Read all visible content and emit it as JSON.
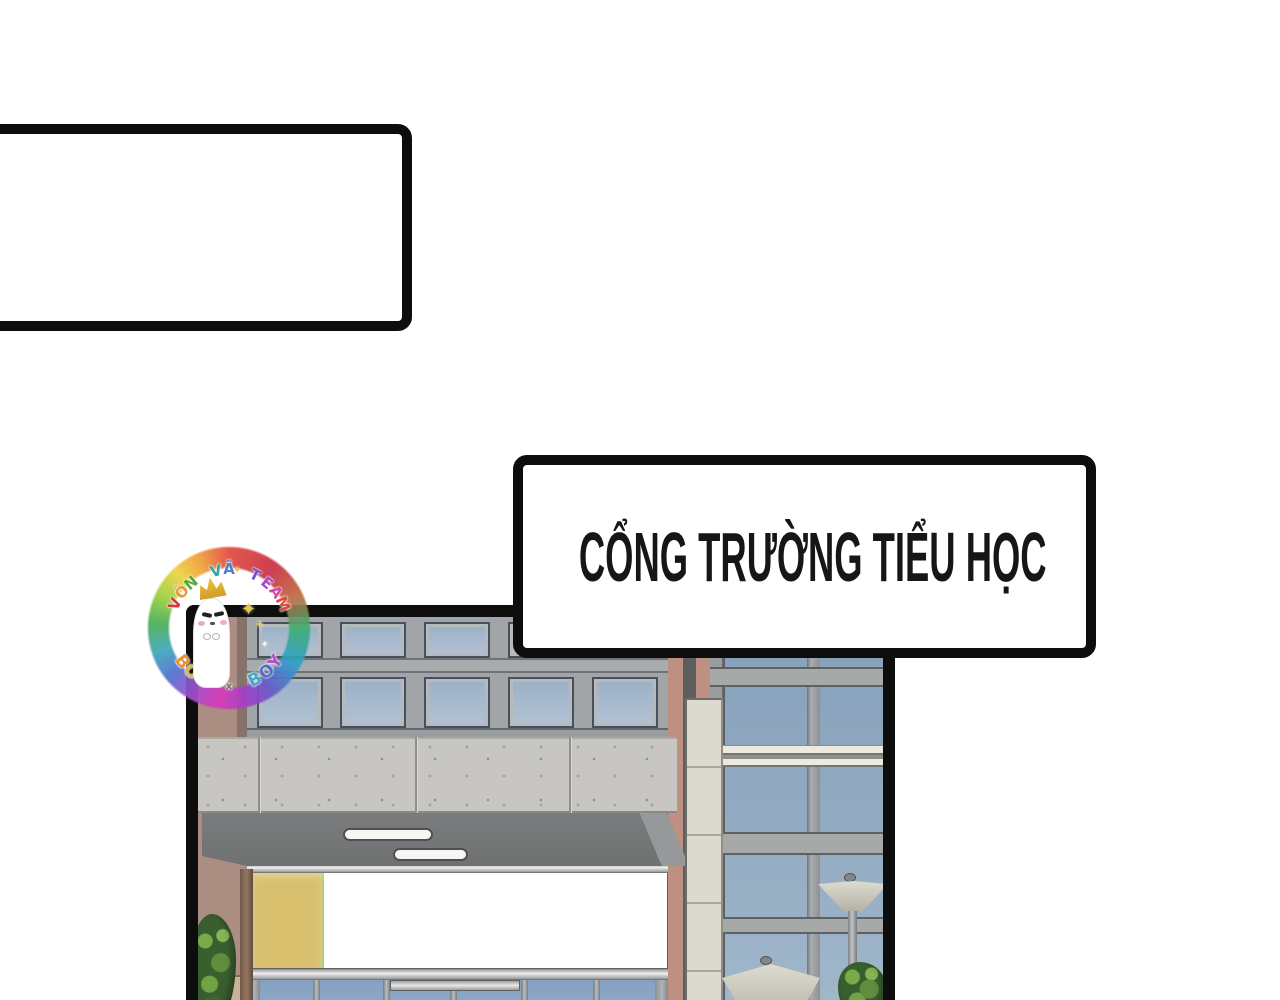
{
  "bubbles": {
    "caption_text": "CỔNG TRƯỜNG TIỂU HỌC",
    "empty_text": ""
  },
  "watermark": {
    "arc_top_text": "VỐN VÃ TEAM",
    "arc_top_colors": [
      "#d8383e",
      "#e8973a",
      "#54a83c",
      "",
      "#2fa79b",
      "#4a7fd0",
      "",
      "#6a55c9",
      "#a845c0",
      "#d8449e",
      "#dc4a3e"
    ],
    "arc_bottom_text": "BOY x BOY",
    "arc_bottom_colors": [
      "#e8923c",
      "#e2b73a",
      "#3fae74",
      "",
      "#777777",
      "",
      "#3fa8c9",
      "#4a6fd0",
      "#b44fd0"
    ],
    "sparkle_glyph": "✦"
  },
  "palette": {
    "ink": "#0d0d0d",
    "paper": "#ffffff",
    "wall-mauve": "#ab8d81",
    "wall-tan": "#c9b49a",
    "column-brown": "#96785f",
    "frame-gray": "#a2a5a7",
    "glass-top": "#9bb0c6",
    "glass-bottom": "#b3c2d3",
    "bigglass-top": "#8fa8c0",
    "bigglass-bottom": "#a2b7ca",
    "concrete": "#c7c6c2",
    "awning": "#6e7071",
    "awning-side": "#96989a",
    "silver-hi": "#f0f0ee",
    "salmon": "#bd9082",
    "strip-dark": "#5c5e60",
    "pillar": "#dcd9cf",
    "band-cream": "#edebdf",
    "lamp": "#d9d7cc",
    "bush-dark": "#3a5f2f",
    "bush-mid": "#6fa344",
    "bush-light": "#79ab4b",
    "panel-yellow": "#d8c06e",
    "panel-orange": "#d0975c",
    "panel-green": "#a8ca69"
  },
  "scene": {
    "facade_panels": [
      "#d8c06e",
      "#d0975c",
      "#a8ca69",
      "#d0975c",
      "#a8ca69",
      "#d8c06e"
    ],
    "window_rows": 2,
    "windows_per_row": 5
  }
}
